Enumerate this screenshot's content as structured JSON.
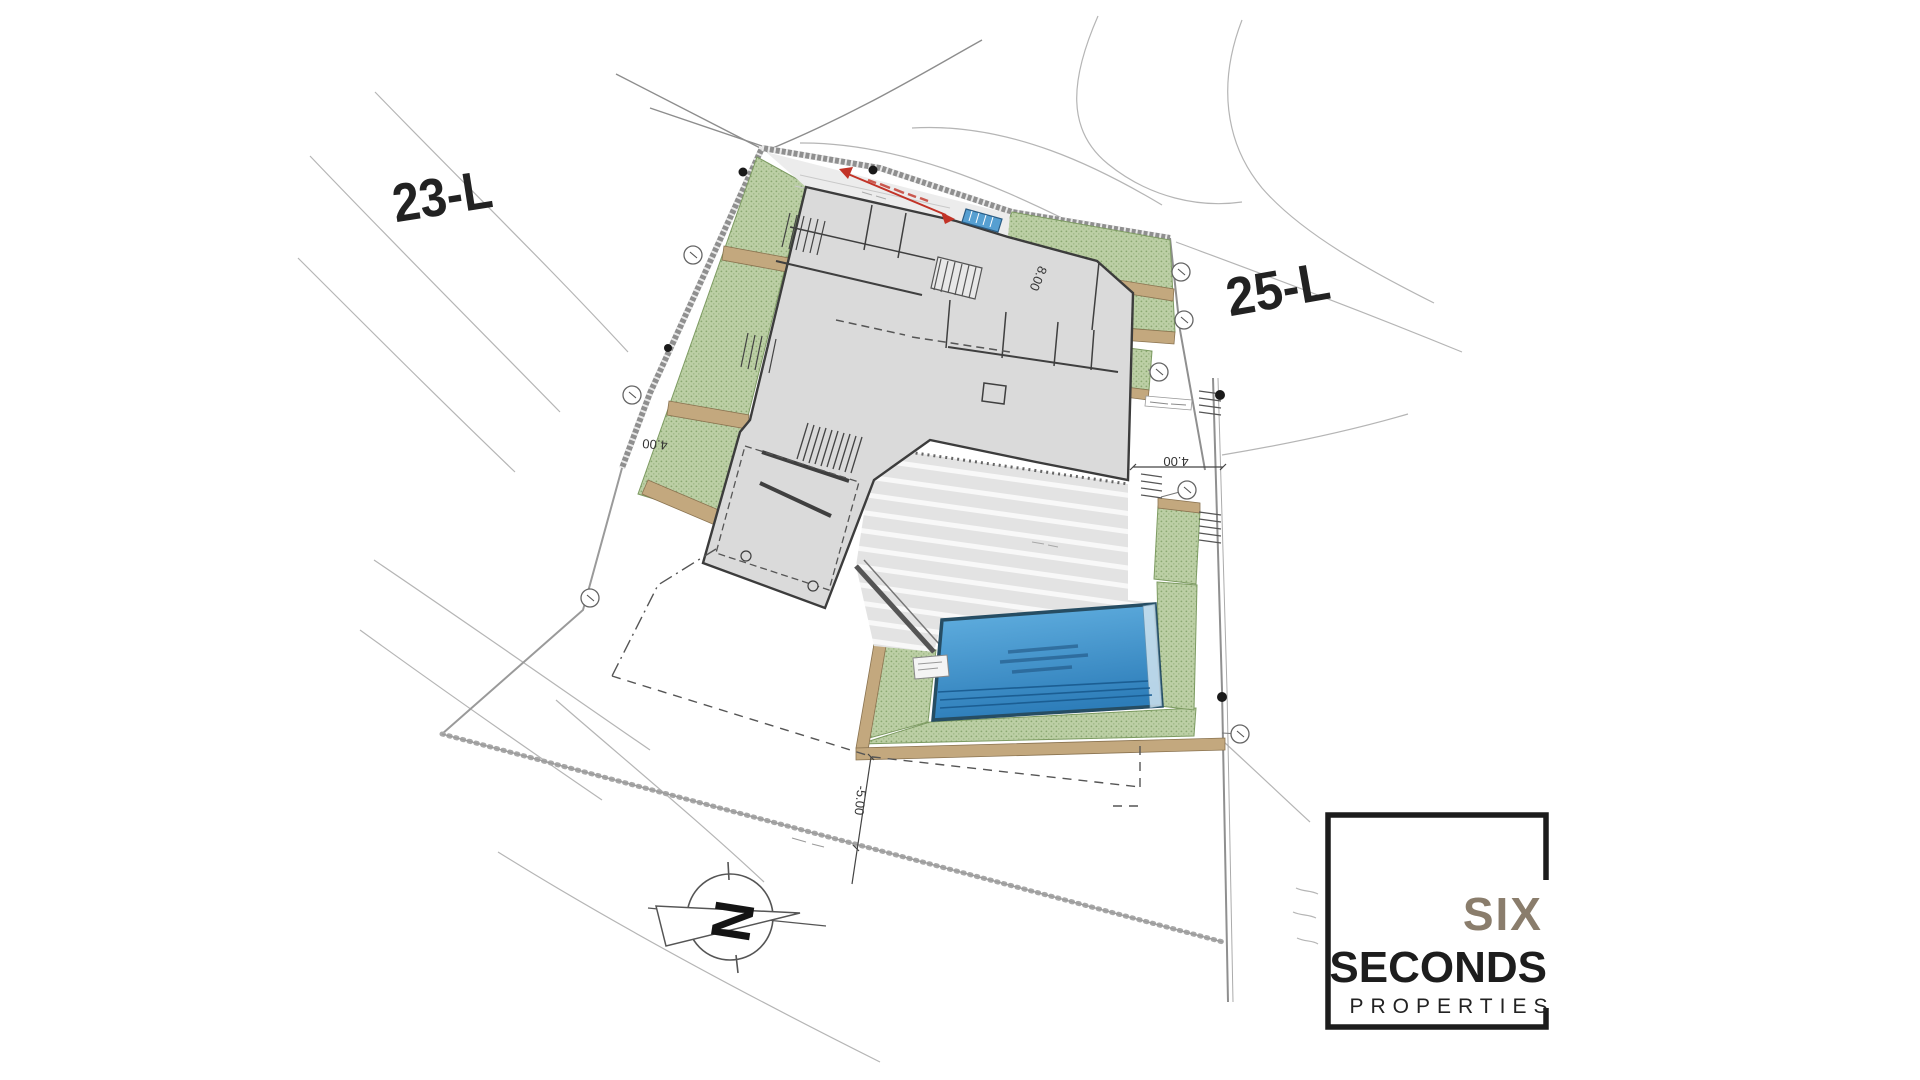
{
  "canvas": {
    "width": 1920,
    "height": 1080,
    "background": "#ffffff"
  },
  "parcels": {
    "left": "23-L",
    "right": "25-L"
  },
  "dimensions": {
    "left_strip_width": "4.00",
    "right_setback": "4.00",
    "upper_bed_width": "8.00",
    "south_setback": "-5.00"
  },
  "compass": {
    "north_letter": "N"
  },
  "logo": {
    "word_top": "SIX",
    "word_main": "SECONDS",
    "word_sub": "PROPERTIES",
    "color_top": "#8a7d6c",
    "color_main": "#1d1d1d"
  },
  "colors": {
    "green_area": "#bccfa5",
    "green_dot": "#8aa871",
    "tan_wall": "#c3a87e",
    "building_fill": "#dadada",
    "wall_stroke": "#3c3c3c",
    "pool_light": "#64b2e2",
    "pool_dark": "#2d7db9",
    "pool_border": "#264d63",
    "accent_red": "#c23327",
    "boundary_gray": "#8f8f8f",
    "contour_gray": "#b5b5b5"
  }
}
